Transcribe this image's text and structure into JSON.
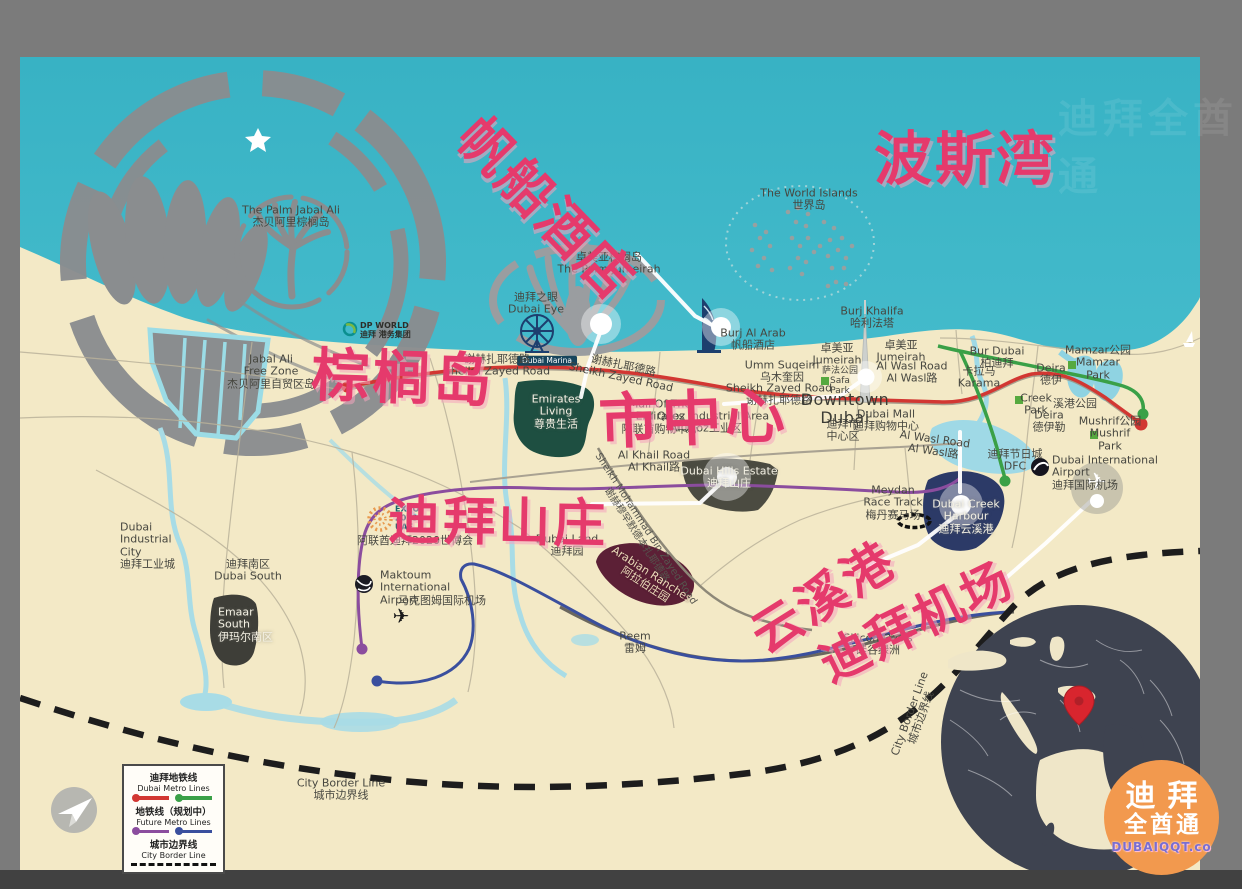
{
  "title": "Dubai tourist map with Chinese annotations",
  "colors": {
    "frame": "#7b7b7b",
    "bottom_bar": "#414141",
    "sea": "#3cb6c8",
    "land": "#f3e9c6",
    "annotation_red": "#e53a6c",
    "metro_red": "#d23732",
    "metro_green": "#3aa047",
    "metro_purple": "#8b4d9e",
    "metro_blue": "#3a4f9e",
    "border_dash": "#1d1d1d",
    "area_green": "#1e4f41",
    "area_olive": "#4b4b41",
    "area_maroon": "#5c2036",
    "area_navy": "#2c3a67",
    "globe": "#3e4350",
    "logo_orange": "#f2994e"
  },
  "annotations": [
    {
      "name": "annotation-burj-al-arab",
      "t": "帆船酒店",
      "x": 499,
      "y": 96,
      "size": 54,
      "rot": 46
    },
    {
      "name": "annotation-persian-gulf",
      "t": "波斯湾",
      "x": 874,
      "y": 112,
      "size": 58,
      "rot": 0
    },
    {
      "name": "annotation-palm-island",
      "t": "棕榈岛",
      "x": 313,
      "y": 328,
      "size": 58,
      "rot": 2
    },
    {
      "name": "annotation-downtown",
      "t": "市中心",
      "x": 597,
      "y": 374,
      "size": 60,
      "rot": -2
    },
    {
      "name": "annotation-dubai-hills",
      "t": "迪拜山庄",
      "x": 389,
      "y": 478,
      "size": 52,
      "rot": 1
    },
    {
      "name": "annotation-creek-harbour",
      "t": "云溪港",
      "x": 735,
      "y": 606,
      "size": 50,
      "rot": -32
    },
    {
      "name": "annotation-dubai-airport",
      "t": "迪拜机场",
      "x": 806,
      "y": 632,
      "size": 49,
      "rot": -26
    }
  ],
  "map_labels": [
    {
      "name": "palm-jabal-ali-label",
      "lines": [
        "The Palm Jabal Ali",
        "杰贝阿里棕榈岛"
      ],
      "x": 291,
      "y": 217
    },
    {
      "name": "world-islands-label",
      "lines": [
        "The World Islands",
        "世界岛"
      ],
      "x": 809,
      "y": 200
    },
    {
      "name": "palm-jumeirah-label",
      "lines": [
        "卓美亚棕榈岛",
        "The Palm Jumeirah"
      ],
      "x": 609,
      "y": 264
    },
    {
      "name": "dubai-eye-label",
      "lines": [
        "迪拜之眼",
        "Dubai Eye"
      ],
      "x": 536,
      "y": 304
    },
    {
      "name": "burj-al-arab-label",
      "lines": [
        "Burj Al Arab",
        "帆船酒店"
      ],
      "x": 753,
      "y": 340
    },
    {
      "name": "burj-khalifa-label",
      "lines": [
        "Burj Khalifa",
        "哈利法塔"
      ],
      "x": 872,
      "y": 318
    },
    {
      "name": "dp-world-label",
      "cls": "tiny",
      "align": "left",
      "lines": [
        "DP WORLD",
        "迪拜 港务集团"
      ],
      "x": 360,
      "y": 331
    },
    {
      "name": "jabal-ali-free-zone-label",
      "lines": [
        "Jabal Ali",
        "Free Zone",
        "杰贝阿里自贸区岛"
      ],
      "x": 271,
      "y": 372
    },
    {
      "name": "dubai-marina-badge",
      "cls": "marina",
      "lines": [
        "Dubai Marina"
      ],
      "x": 547,
      "y": 361
    },
    {
      "name": "sheikh-zayed-road-label-1",
      "lines": [
        "谢赫扎耶德路",
        "Sheikh Zayed Road"
      ],
      "x": 497,
      "y": 366
    },
    {
      "name": "sheikh-zayed-road-label-2",
      "rot": 12,
      "lines": [
        "谢赫扎耶德路",
        "Sheikh Zayed Road"
      ],
      "x": 622,
      "y": 372
    },
    {
      "name": "sheikh-zayed-road-label-3",
      "lines": [
        "Sheikh Zayed Road",
        "谢赫扎耶德路"
      ],
      "x": 779,
      "y": 395
    },
    {
      "name": "jumeirah-label-1",
      "lines": [
        "卓美亚",
        "Jumeirah"
      ],
      "x": 837,
      "y": 355
    },
    {
      "name": "jumeirah-label-2",
      "lines": [
        "卓美亚",
        "Jumeirah"
      ],
      "x": 901,
      "y": 352
    },
    {
      "name": "umm-suqeim-label",
      "lines": [
        "Umm Suqeim",
        "乌木奎因"
      ],
      "x": 782,
      "y": 372
    },
    {
      "name": "al-wasl-road-label-1",
      "lines": [
        "Al Wasl Road",
        "Al Wasl路"
      ],
      "x": 912,
      "y": 373
    },
    {
      "name": "safa-park-label",
      "cls": "small",
      "lines": [
        "萨法公园",
        "Safa",
        "Park"
      ],
      "x": 840,
      "y": 381
    },
    {
      "name": "downtown-dubai-label",
      "cls": "big",
      "lines": [
        "Downtown",
        "Dubai"
      ],
      "x": 845,
      "y": 409
    },
    {
      "name": "downtown-dubai-cn-label",
      "lines": [
        "迪拜市",
        "中心区"
      ],
      "x": 843,
      "y": 431
    },
    {
      "name": "dubai-mall-label",
      "lines": [
        "Dubai Mall",
        "迪拜购物中心"
      ],
      "x": 886,
      "y": 421
    },
    {
      "name": "al-quoz-label",
      "lines": [
        "Al Quoz Industrial Area",
        "AlQuoz工业区"
      ],
      "x": 706,
      "y": 423
    },
    {
      "name": "mall-of-emirates-label",
      "lines": [
        "Mall Of The",
        "Emirates",
        "阿联酋购物中心"
      ],
      "x": 660,
      "y": 417
    },
    {
      "name": "emirates-living-label",
      "cls": "white",
      "lines": [
        "Emirates",
        "Living",
        "尊贵生活"
      ],
      "x": 556,
      "y": 412
    },
    {
      "name": "al-khail-road-label",
      "lines": [
        "Al Khail Road",
        "Al Khail路"
      ],
      "x": 654,
      "y": 462
    },
    {
      "name": "dubai-hills-estate-label",
      "cls": "white",
      "lines": [
        "Dubai Hills Estate",
        "迪拜山庄"
      ],
      "x": 729,
      "y": 478
    },
    {
      "name": "smbz-road-label",
      "cls": "road",
      "rot": 57,
      "lines": [
        "Sheikh Mohammad Bin Zayed Road",
        "谢赫穆罕默德本扎耶德路"
      ],
      "x": 641,
      "y": 532
    },
    {
      "name": "meydan-label",
      "lines": [
        "Meydan",
        "Race Track",
        "梅丹赛马场"
      ],
      "x": 893,
      "y": 503
    },
    {
      "name": "dubai-creek-harbour-label",
      "cls": "white",
      "lines": [
        "Dubai Creek",
        "Harbour",
        "迪拜云溪港"
      ],
      "x": 966,
      "y": 517
    },
    {
      "name": "al-wasl-road-label-2",
      "rot": 8,
      "lines": [
        "Al Wasl Road",
        "Al Wasl路"
      ],
      "x": 934,
      "y": 446
    },
    {
      "name": "bur-dubai-label",
      "lines": [
        "Bur Dubai",
        "柏迪拜"
      ],
      "x": 997,
      "y": 358
    },
    {
      "name": "karama-label",
      "lines": [
        "卡拉马",
        "Karama"
      ],
      "x": 979,
      "y": 378
    },
    {
      "name": "mamzar-park-label",
      "lines": [
        "Mamzar公园",
        "Mamzar",
        "Park"
      ],
      "x": 1098,
      "y": 363
    },
    {
      "name": "deira-label-1",
      "lines": [
        "Deira",
        "德伊"
      ],
      "x": 1051,
      "y": 375
    },
    {
      "name": "creek-park-label",
      "lines": [
        "Creek",
        "Park"
      ],
      "x": 1036,
      "y": 405
    },
    {
      "name": "creek-park-cn-label",
      "lines": [
        "溪港公园"
      ],
      "x": 1075,
      "y": 404
    },
    {
      "name": "deira-label-2",
      "lines": [
        "Deira",
        "德伊勒"
      ],
      "x": 1049,
      "y": 422
    },
    {
      "name": "mushrif-park-label",
      "lines": [
        "Mushrif公园",
        "Mushrif",
        "Park"
      ],
      "x": 1110,
      "y": 434
    },
    {
      "name": "dubai-festival-city-label",
      "lines": [
        "迪拜节日城",
        "DFC"
      ],
      "x": 1015,
      "y": 461
    },
    {
      "name": "dubai-intl-airport-label",
      "align": "left",
      "lines": [
        "Dubai International",
        "Airport",
        "迪拜国际机场"
      ],
      "x": 1052,
      "y": 473
    },
    {
      "name": "dubai-industrial-city-label",
      "align": "left",
      "lines": [
        "Dubai",
        "Industrial",
        "City",
        "迪拜工业城"
      ],
      "x": 120,
      "y": 546
    },
    {
      "name": "dubai-south-label",
      "lines": [
        "迪拜南区",
        "Dubai South"
      ],
      "x": 248,
      "y": 571
    },
    {
      "name": "emaar-south-label",
      "cls": "white",
      "align": "left",
      "lines": [
        "Emaar",
        "South",
        "伊玛尔南区"
      ],
      "x": 218,
      "y": 625
    },
    {
      "name": "expo-2020-label",
      "cls": "expo",
      "align": "left",
      "lines": [
        "EXPO",
        "2020",
        "UAE"
      ],
      "x": 395,
      "y": 519
    },
    {
      "name": "expo-2020-cn-label",
      "lines": [
        "阿联酋迪拜2020世博会"
      ],
      "x": 415,
      "y": 541
    },
    {
      "name": "maktoum-airport-label",
      "align": "left",
      "lines": [
        "Maktoum",
        "International",
        "Airport"
      ],
      "x": 380,
      "y": 588
    },
    {
      "name": "maktoum-airport-cn-label",
      "lines": [
        "马克图姆国际机场"
      ],
      "x": 442,
      "y": 601
    },
    {
      "name": "dubai-land-label",
      "lines": [
        "Dubai Land",
        "迪拜园"
      ],
      "x": 567,
      "y": 546
    },
    {
      "name": "arabian-ranches-label",
      "cls": "cream",
      "rot": 33,
      "lines": [
        "Arabian Ranches",
        "阿拉伯庄园"
      ],
      "x": 648,
      "y": 580
    },
    {
      "name": "reem-label",
      "lines": [
        "Reem",
        "雷姆"
      ],
      "x": 635,
      "y": 643
    },
    {
      "name": "silicon-oasis-label",
      "lines": [
        "Silicon Oasis",
        "硅谷绿洲"
      ],
      "x": 878,
      "y": 645
    },
    {
      "name": "city-border-label-bottom",
      "lines": [
        "City Border Line",
        "城市边界线"
      ],
      "x": 341,
      "y": 790
    },
    {
      "name": "city-border-label-right",
      "rot": -70,
      "lines": [
        "City Border Line",
        "城市边界线"
      ],
      "x": 916,
      "y": 716
    }
  ],
  "legend": {
    "metro_cn": "迪拜地铁线",
    "metro_en": "Dubai Metro Lines",
    "future_cn": "地铁线（规划中）",
    "future_en": "Future Metro Lines",
    "border_cn": "城市边界线",
    "border_en": "City Border Line"
  },
  "logo": {
    "line1": "迪拜",
    "line2": "全酋通",
    "line3": "DUBAIQQT.co"
  },
  "watermark": "迪拜全酋通"
}
